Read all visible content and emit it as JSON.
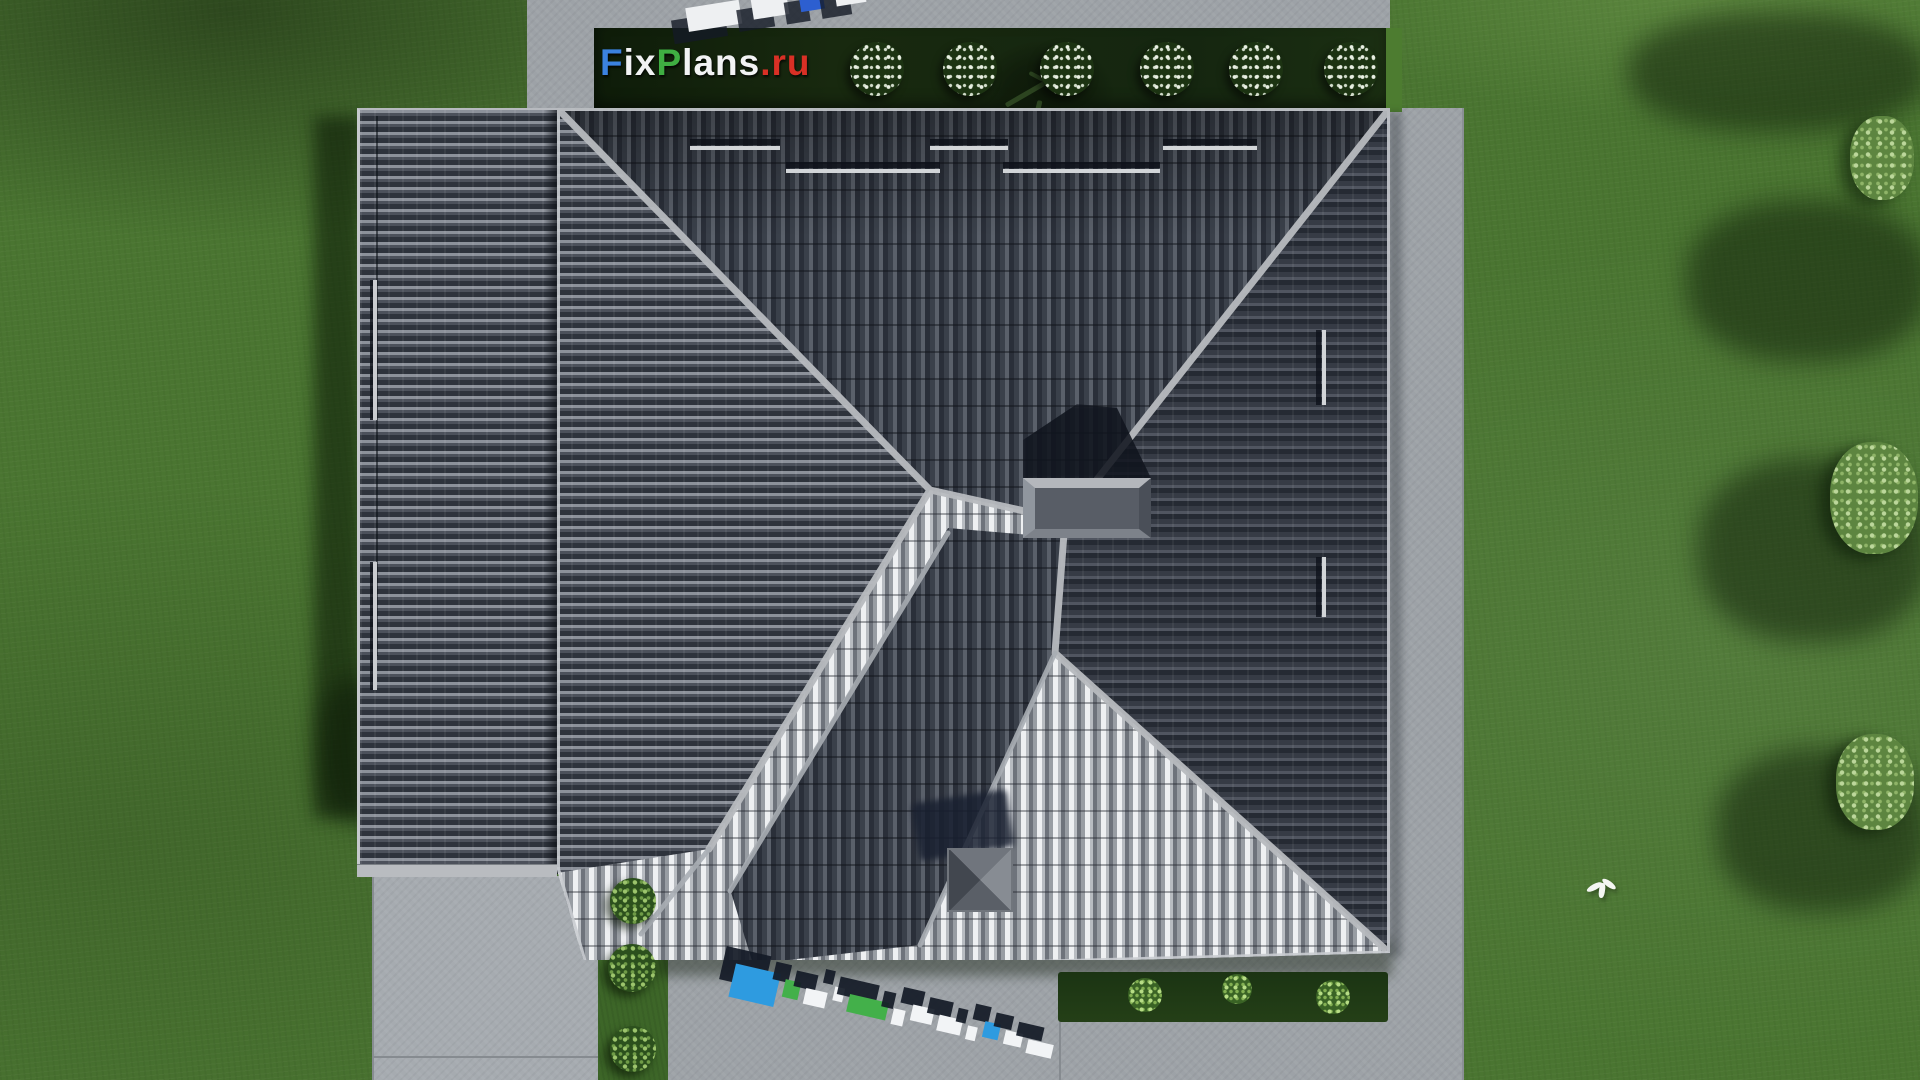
{
  "meta": {
    "site_watermark": "FixPlans.ru",
    "view": "aerial top-down render of hip-roof house"
  },
  "watermarks": {
    "logo": {
      "text": "FixPlans.ru",
      "letters": [
        {
          "ch": "F",
          "color": "#3b82e0"
        },
        {
          "ch": "i",
          "color": "#f2f3f4"
        },
        {
          "ch": "x",
          "color": "#f2f3f4"
        },
        {
          "ch": "P",
          "color": "#3fae42"
        },
        {
          "ch": "l",
          "color": "#f2f3f4"
        },
        {
          "ch": "a",
          "color": "#f2f3f4"
        },
        {
          "ch": "n",
          "color": "#f2f3f4"
        },
        {
          "ch": "s",
          "color": "#f2f3f4"
        },
        {
          "ch": ".",
          "color": "#d93025"
        },
        {
          "ch": "r",
          "color": "#d93025"
        },
        {
          "ch": "u",
          "color": "#d93025"
        }
      ]
    },
    "ground_3d_bottom": {
      "text": "FixPlans.ru",
      "slabs": [
        {
          "w": 46,
          "h": 34,
          "c": "#2e9be0"
        },
        {
          "w": 16,
          "h": 18,
          "c": "#43b04a"
        },
        {
          "w": 22,
          "h": 16,
          "c": "#f2f4f6"
        },
        {
          "w": 10,
          "h": 14,
          "c": "#f2f4f6"
        },
        {
          "w": 40,
          "h": 18,
          "c": "#43b04a"
        },
        {
          "w": 12,
          "h": 16,
          "c": "#f2f4f6"
        },
        {
          "w": 22,
          "h": 16,
          "c": "#f2f4f6"
        },
        {
          "w": 24,
          "h": 16,
          "c": "#f2f4f6"
        },
        {
          "w": 10,
          "h": 14,
          "c": "#f2f4f6"
        },
        {
          "w": 16,
          "h": 16,
          "c": "#2e9be0"
        },
        {
          "w": 18,
          "h": 14,
          "c": "#f2f4f6"
        },
        {
          "w": 26,
          "h": 14,
          "c": "#f2f4f6"
        }
      ]
    },
    "ground_3d_top_partial": {
      "slabs": [
        {
          "w": 54,
          "h": 24,
          "c": "#eef0f2"
        },
        {
          "w": 36,
          "h": 22,
          "c": "#eef0f2"
        },
        {
          "w": 24,
          "h": 22,
          "c": "#2d5fd0"
        },
        {
          "w": 30,
          "h": 22,
          "c": "#eef0f2"
        }
      ]
    }
  },
  "scene": {
    "colors": {
      "grass": "#4a7531",
      "grass_dark": "#223a18",
      "hedge": "#16270f",
      "pavement": "#9da2a7",
      "roof_dark": "#2f343e",
      "roof_bright": "#d7d9dc",
      "ridge": "#b8bbbf",
      "logo_blue": "#3b82e0",
      "logo_green": "#3fae42",
      "logo_red": "#d93025",
      "logo_white": "#f2f3f4"
    },
    "top_bushes": {
      "y": 42,
      "size": 54,
      "centers": [
        877,
        970,
        1067,
        1167,
        1256,
        1351
      ]
    },
    "strip_bushes": [
      {
        "x": 610,
        "y": 878,
        "s": 46
      },
      {
        "x": 608,
        "y": 944,
        "s": 48
      },
      {
        "x": 610,
        "y": 1026,
        "s": 46
      }
    ],
    "bed_bushes": [
      {
        "x": 1128,
        "y": 978,
        "s": 34
      },
      {
        "x": 1222,
        "y": 974,
        "s": 30
      },
      {
        "x": 1316,
        "y": 980,
        "s": 34
      }
    ],
    "right_trees": [
      {
        "x": 1850,
        "y": 116,
        "w": 64,
        "h": 84
      },
      {
        "x": 1830,
        "y": 442,
        "w": 88,
        "h": 112
      },
      {
        "x": 1836,
        "y": 734,
        "w": 78,
        "h": 96
      }
    ],
    "tree_shadows": [
      {
        "x": 1628,
        "y": 12,
        "w": 300,
        "h": 120
      },
      {
        "x": 1686,
        "y": 200,
        "w": 244,
        "h": 162
      },
      {
        "x": 1698,
        "y": 458,
        "w": 232,
        "h": 184
      },
      {
        "x": 1716,
        "y": 748,
        "w": 214,
        "h": 164
      }
    ],
    "snow_guards_horizontal": [
      {
        "y": 38,
        "segments": [
          [
            133,
            90
          ],
          [
            373,
            78
          ],
          [
            606,
            94
          ]
        ]
      },
      {
        "y": 61,
        "segments": [
          [
            229,
            154
          ],
          [
            446,
            157
          ]
        ]
      }
    ],
    "snow_guards_vertical": [
      {
        "x": 765,
        "y": 222,
        "h": 75
      },
      {
        "x": 765,
        "y": 449,
        "h": 60
      }
    ],
    "left_wing_bars": [
      {
        "y": 170,
        "h": 140
      },
      {
        "y": 452,
        "h": 128
      }
    ]
  }
}
